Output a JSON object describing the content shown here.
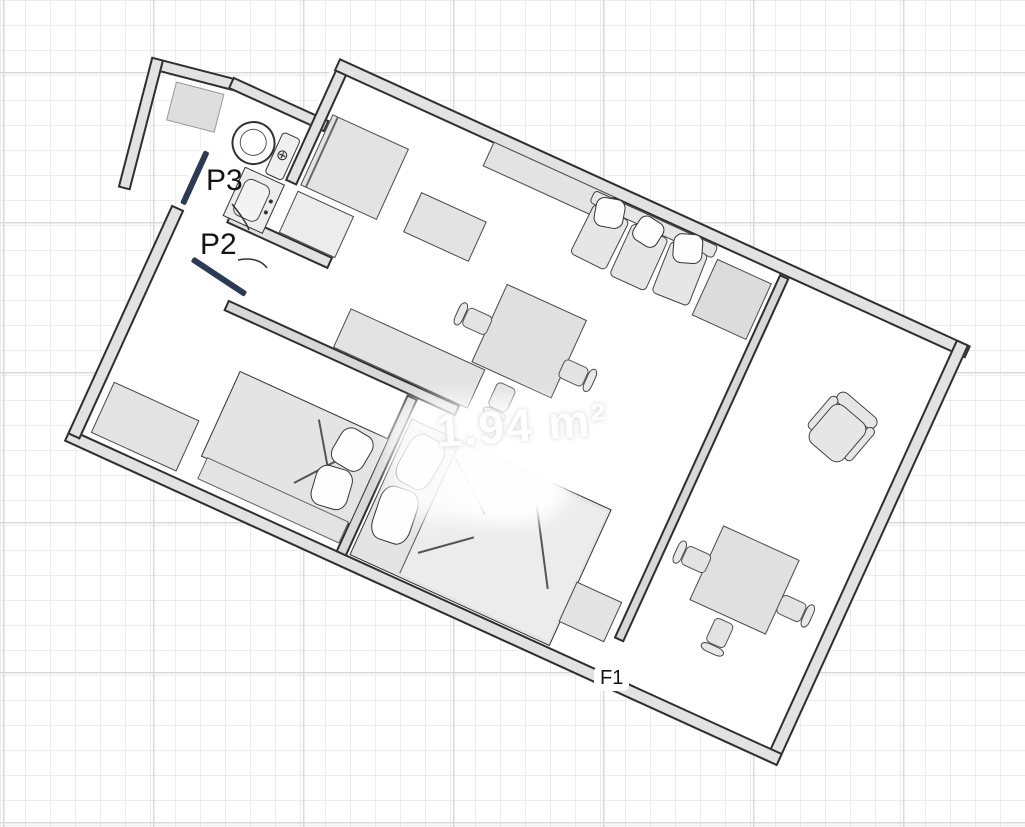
{
  "plan": {
    "type": "apartment-floor-plan",
    "labels": {
      "p3": "P3",
      "p2": "P2",
      "f1": "F1"
    },
    "watermark": {
      "area_text": "1.94 m²"
    },
    "colors": {
      "door_leaf": "#2b3a55",
      "wall_fill": "#e2e2e2",
      "wall_outline": "#2f2f2f",
      "furniture_fill": "#e3e3e3",
      "floor": "#ffffff",
      "grid_minor": "#ececec",
      "grid_major": "#d9d9d9"
    }
  }
}
